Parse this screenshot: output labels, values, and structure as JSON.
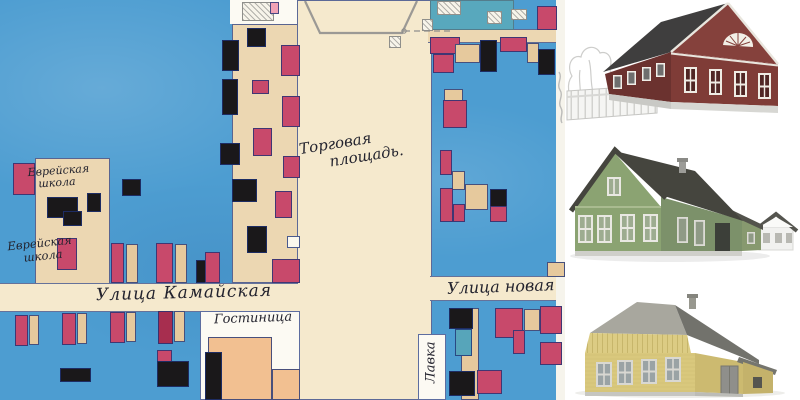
{
  "css_vars": {
    "--map-water": "#4d9dd1",
    "--map-ink": "#23232e",
    "--panel-bg": "#ffffff"
  },
  "map": {
    "palette": {
      "R": "#c8496b",
      "D": "#a72e4f",
      "K": "#1a181a",
      "T": "#e6c99d",
      "W": "#fbf8ee",
      "O": "#f2c091",
      "TL": "#57a5ba",
      "TL2": "#58a8bd",
      "TS": "#ecd7b2",
      "CS": "#f5e9cd",
      "W2": "#fcfaf3",
      "W3": "#f6f4ec",
      "P": "#f0a2b6"
    },
    "labels": {
      "market_square_line1": "Торговая",
      "market_square_line2": "площадь.",
      "school_upper_line1": "Еврейская",
      "school_upper_line2": "школа",
      "school_lower_line1": "Еврейская",
      "school_lower_line2": "школа",
      "street_kamayskaya": "Улица Камайская",
      "street_novaya": "Улица новая",
      "hotel": "Гостиница",
      "shop": "Лавка"
    },
    "regions": [
      {
        "name": "top-white-notch",
        "x": 230,
        "y": 0,
        "w": 67,
        "h": 24,
        "c": "W2"
      },
      {
        "name": "left-street-column",
        "x": 232,
        "y": 24,
        "w": 66,
        "h": 259,
        "c": "TS",
        "cls": "inked"
      },
      {
        "name": "central-market-square",
        "x": 297,
        "y": 0,
        "w": 135,
        "h": 400,
        "c": "CS",
        "cls": "inked"
      },
      {
        "name": "schools-street-column",
        "x": 35,
        "y": 158,
        "w": 75,
        "h": 126,
        "c": "TS",
        "cls": "inked"
      },
      {
        "name": "street-band-left",
        "x": 0,
        "y": 283,
        "w": 298,
        "h": 29,
        "c": "CS",
        "cls": "inked-h"
      },
      {
        "name": "street-band-right",
        "x": 430,
        "y": 276,
        "w": 135,
        "h": 25,
        "c": "CS",
        "cls": "inked-h"
      },
      {
        "name": "top-right-strip",
        "x": 428,
        "y": 29,
        "w": 137,
        "h": 14,
        "c": "TS",
        "cls": "inked-h"
      },
      {
        "name": "teal-hatched-block",
        "x": 430,
        "y": 0,
        "w": 84,
        "h": 30,
        "c": "TL2",
        "cls": "hatch"
      },
      {
        "name": "hotel-block",
        "x": 200,
        "y": 311,
        "w": 100,
        "h": 89,
        "c": "W2",
        "cls": "inked"
      },
      {
        "name": "lavka-strip",
        "x": 418,
        "y": 334,
        "w": 28,
        "h": 66,
        "c": "W2",
        "cls": "inked"
      },
      {
        "name": "right-margin",
        "x": 556,
        "y": 0,
        "w": 9,
        "h": 400,
        "c": "W3"
      }
    ],
    "blocks": [
      {
        "x": 222,
        "y": 40,
        "w": 17,
        "h": 31,
        "c": "K"
      },
      {
        "x": 222,
        "y": 79,
        "w": 16,
        "h": 36,
        "c": "K"
      },
      {
        "x": 242,
        "y": 2,
        "w": 32,
        "h": 19,
        "cls": "pencil-box"
      },
      {
        "x": 270,
        "y": 2,
        "w": 9,
        "h": 12,
        "c": "P"
      },
      {
        "x": 247,
        "y": 28,
        "w": 19,
        "h": 19,
        "c": "K"
      },
      {
        "x": 281,
        "y": 45,
        "w": 19,
        "h": 31,
        "c": "R"
      },
      {
        "x": 252,
        "y": 80,
        "w": 17,
        "h": 14,
        "c": "R"
      },
      {
        "x": 282,
        "y": 96,
        "w": 18,
        "h": 31,
        "c": "R"
      },
      {
        "x": 253,
        "y": 128,
        "w": 19,
        "h": 28,
        "c": "R"
      },
      {
        "x": 220,
        "y": 143,
        "w": 20,
        "h": 22,
        "c": "K"
      },
      {
        "x": 283,
        "y": 156,
        "w": 17,
        "h": 22,
        "c": "R"
      },
      {
        "x": 232,
        "y": 179,
        "w": 25,
        "h": 23,
        "c": "K"
      },
      {
        "x": 275,
        "y": 191,
        "w": 17,
        "h": 27,
        "c": "R"
      },
      {
        "x": 247,
        "y": 226,
        "w": 20,
        "h": 27,
        "c": "K"
      },
      {
        "x": 287,
        "y": 236,
        "w": 13,
        "h": 12,
        "c": "W"
      },
      {
        "x": 272,
        "y": 259,
        "w": 28,
        "h": 24,
        "c": "R"
      },
      {
        "x": 13,
        "y": 163,
        "w": 22,
        "h": 32,
        "c": "R"
      },
      {
        "x": 47,
        "y": 197,
        "w": 31,
        "h": 21,
        "c": "K"
      },
      {
        "x": 63,
        "y": 211,
        "w": 19,
        "h": 15,
        "c": "K"
      },
      {
        "x": 57,
        "y": 238,
        "w": 20,
        "h": 32,
        "c": "R"
      },
      {
        "x": 122,
        "y": 179,
        "w": 19,
        "h": 17,
        "c": "K"
      },
      {
        "x": 87,
        "y": 193,
        "w": 14,
        "h": 19,
        "c": "K"
      },
      {
        "x": 111,
        "y": 243,
        "w": 13,
        "h": 40,
        "c": "R"
      },
      {
        "x": 126,
        "y": 244,
        "w": 12,
        "h": 39,
        "c": "T"
      },
      {
        "x": 156,
        "y": 243,
        "w": 17,
        "h": 40,
        "c": "R"
      },
      {
        "x": 175,
        "y": 244,
        "w": 12,
        "h": 39,
        "c": "T"
      },
      {
        "x": 196,
        "y": 260,
        "w": 15,
        "h": 23,
        "c": "K"
      },
      {
        "x": 205,
        "y": 252,
        "w": 15,
        "h": 31,
        "c": "R"
      },
      {
        "x": 15,
        "y": 315,
        "w": 13,
        "h": 31,
        "c": "R"
      },
      {
        "x": 29,
        "y": 315,
        "w": 10,
        "h": 30,
        "c": "T"
      },
      {
        "x": 62,
        "y": 313,
        "w": 14,
        "h": 32,
        "c": "R"
      },
      {
        "x": 77,
        "y": 313,
        "w": 10,
        "h": 31,
        "c": "T"
      },
      {
        "x": 110,
        "y": 312,
        "w": 15,
        "h": 31,
        "c": "R"
      },
      {
        "x": 126,
        "y": 312,
        "w": 10,
        "h": 30,
        "c": "T"
      },
      {
        "x": 158,
        "y": 311,
        "w": 15,
        "h": 33,
        "c": "D"
      },
      {
        "x": 174,
        "y": 311,
        "w": 11,
        "h": 31,
        "c": "T"
      },
      {
        "x": 60,
        "y": 368,
        "w": 31,
        "h": 14,
        "c": "K"
      },
      {
        "x": 157,
        "y": 350,
        "w": 15,
        "h": 13,
        "c": "R"
      },
      {
        "x": 157,
        "y": 361,
        "w": 32,
        "h": 26,
        "c": "K"
      },
      {
        "x": 208,
        "y": 337,
        "w": 64,
        "h": 63,
        "c": "O"
      },
      {
        "x": 272,
        "y": 369,
        "w": 28,
        "h": 31,
        "c": "O"
      },
      {
        "x": 205,
        "y": 352,
        "w": 17,
        "h": 48,
        "c": "K"
      },
      {
        "x": 461,
        "y": 308,
        "w": 18,
        "h": 92,
        "c": "T"
      },
      {
        "x": 449,
        "y": 308,
        "w": 24,
        "h": 21,
        "c": "K"
      },
      {
        "x": 455,
        "y": 329,
        "w": 17,
        "h": 27,
        "c": "TL"
      },
      {
        "x": 449,
        "y": 371,
        "w": 26,
        "h": 25,
        "c": "K"
      },
      {
        "x": 477,
        "y": 370,
        "w": 25,
        "h": 24,
        "c": "R"
      },
      {
        "x": 495,
        "y": 308,
        "w": 28,
        "h": 30,
        "c": "R"
      },
      {
        "x": 513,
        "y": 330,
        "w": 12,
        "h": 24,
        "c": "R"
      },
      {
        "x": 524,
        "y": 309,
        "w": 16,
        "h": 22,
        "c": "T"
      },
      {
        "x": 540,
        "y": 306,
        "w": 22,
        "h": 28,
        "c": "R"
      },
      {
        "x": 540,
        "y": 342,
        "w": 22,
        "h": 23,
        "c": "R"
      },
      {
        "x": 437,
        "y": 1,
        "w": 24,
        "h": 14,
        "cls": "pencil-box"
      },
      {
        "x": 487,
        "y": 11,
        "w": 15,
        "h": 13,
        "cls": "pencil-box"
      },
      {
        "x": 511,
        "y": 9,
        "w": 16,
        "h": 11,
        "cls": "pencil-box"
      },
      {
        "x": 537,
        "y": 6,
        "w": 20,
        "h": 24,
        "c": "R"
      },
      {
        "x": 430,
        "y": 37,
        "w": 30,
        "h": 17,
        "c": "R"
      },
      {
        "x": 433,
        "y": 54,
        "w": 21,
        "h": 19,
        "c": "R"
      },
      {
        "x": 455,
        "y": 44,
        "w": 25,
        "h": 19,
        "c": "T"
      },
      {
        "x": 480,
        "y": 40,
        "w": 17,
        "h": 32,
        "c": "K"
      },
      {
        "x": 500,
        "y": 37,
        "w": 27,
        "h": 15,
        "c": "R"
      },
      {
        "x": 527,
        "y": 43,
        "w": 12,
        "h": 20,
        "c": "T"
      },
      {
        "x": 538,
        "y": 49,
        "w": 17,
        "h": 26,
        "c": "K"
      },
      {
        "x": 444,
        "y": 89,
        "w": 19,
        "h": 12,
        "c": "T"
      },
      {
        "x": 443,
        "y": 100,
        "w": 24,
        "h": 28,
        "c": "R"
      },
      {
        "x": 440,
        "y": 150,
        "w": 12,
        "h": 25,
        "c": "R"
      },
      {
        "x": 452,
        "y": 171,
        "w": 13,
        "h": 19,
        "c": "T"
      },
      {
        "x": 440,
        "y": 188,
        "w": 13,
        "h": 34,
        "c": "R"
      },
      {
        "x": 453,
        "y": 204,
        "w": 12,
        "h": 18,
        "c": "R"
      },
      {
        "x": 465,
        "y": 184,
        "w": 23,
        "h": 26,
        "c": "T"
      },
      {
        "x": 490,
        "y": 189,
        "w": 17,
        "h": 18,
        "c": "K"
      },
      {
        "x": 490,
        "y": 206,
        "w": 17,
        "h": 16,
        "c": "R"
      },
      {
        "x": 547,
        "y": 262,
        "w": 18,
        "h": 15,
        "c": "T"
      },
      {
        "x": 389,
        "y": 36,
        "w": 12,
        "h": 12,
        "cls": "pencil-box"
      },
      {
        "x": 422,
        "y": 19,
        "w": 11,
        "h": 12,
        "cls": "pencil-box"
      }
    ]
  },
  "panel": {
    "houses": [
      {
        "id": "red-log-house",
        "colors": {
          "wall": "#7f3c37",
          "wall-shade": "#6b322f",
          "gable": "#85413c",
          "roof": "#3f3e3e",
          "trim": "#efece4"
        }
      },
      {
        "id": "green-wooden-house",
        "colors": {
          "wall": "#8ba372",
          "wall-shade": "#7c916a",
          "roof": "#45453e",
          "trim": "#e9e8e2"
        }
      },
      {
        "id": "yellow-wooden-house",
        "colors": {
          "wall": "#d9c87d",
          "wall-shade": "#ccba70",
          "band": "#dccc84",
          "roof": "#72726c",
          "roof-light": "#a8a79e",
          "trim": "#d9d8d2"
        }
      }
    ]
  }
}
